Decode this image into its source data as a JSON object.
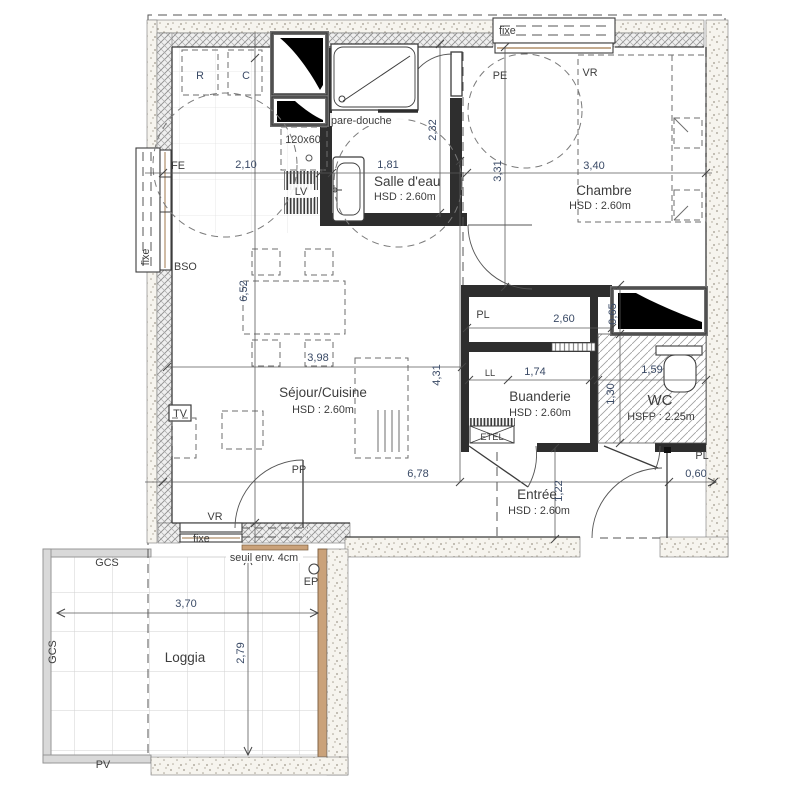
{
  "plan_title": "Appartement - plan d'étage",
  "rooms": {
    "sejour": {
      "name": "Séjour/Cuisine",
      "hsd": "HSD : 2.60m"
    },
    "salle_deau": {
      "name": "Salle d'eau",
      "hsd": "HSD : 2.60m"
    },
    "chambre": {
      "name": "Chambre",
      "hsd": "HSD : 2.60m"
    },
    "buanderie": {
      "name": "Buanderie",
      "hsd": "HSD : 2.60m"
    },
    "wc": {
      "name": "WC",
      "hsfp": "HSFP : 2.25m"
    },
    "entree": {
      "name": "Entrée",
      "hsd": "HSD : 2.60m"
    },
    "loggia": {
      "name": "Loggia"
    }
  },
  "dimensions": {
    "kitchen_width": "2,10",
    "bath_width": "1,81",
    "chambre_width": "3,40",
    "sejour_depth": "6,52",
    "bath_depth": "2,32",
    "chambre_depth": "3,31",
    "sejour_width": "3,98",
    "sejour_height": "4,31",
    "total_width": "6,78",
    "entree_depth": "1,22",
    "closet_width": "2,60",
    "closet_depth": "0,65",
    "buanderie_width": "1,74",
    "wc_depth": "1,30",
    "wc_width": "1,59",
    "entrance_width": "0,60",
    "loggia_width": "3,70",
    "loggia_depth": "2,79"
  },
  "annotations": {
    "fixe_top": "fixe",
    "pe": "PE",
    "vr_top": "VR",
    "fe_left": "FE",
    "fixe_left": "fixe",
    "bso": "BSO",
    "fridge": "R",
    "cooking": "C",
    "worktop": "120x60",
    "dishwasher": "LV",
    "shower_screen": "pare-douche",
    "tv": "TV",
    "closet_pl": "PL",
    "washer": "LL",
    "etel": "ETEL",
    "entrance_pl": "PL",
    "pp": "PP",
    "vr_bottom": "VR",
    "fixe_bottom": "fixe",
    "threshold": "seuil env. 4cm",
    "ep": "EP",
    "gcs_top": "GCS",
    "gcs_left": "GCS",
    "pv": "PV"
  },
  "colors": {
    "line": "#3a3a3a",
    "dim_text": "#3a4a66",
    "wall_fill": "#2e2e2e",
    "tan": "#b08f6a",
    "railing": "#d9d9d9"
  }
}
